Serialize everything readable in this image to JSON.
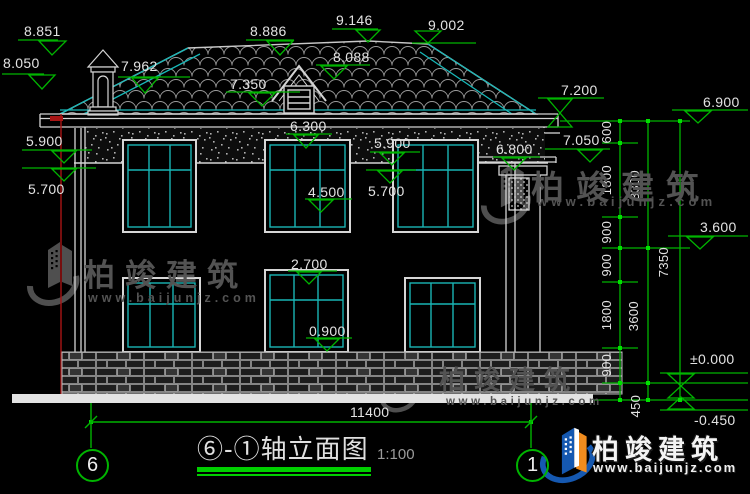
{
  "title_block": {
    "name": "⑥-①轴立面图",
    "scale": "1:100"
  },
  "axis": {
    "left": "6",
    "right": "1"
  },
  "elevations": {
    "v8851": "8.851",
    "v8050": "8.050",
    "v7962": "7.962",
    "v8886": "8.886",
    "v9146": "9.146",
    "v9002": "9.002",
    "v8088": "8.088",
    "v7350": "7.350",
    "v6300": "6.300",
    "v5900_left": "5.900",
    "v5700_left": "5.700",
    "v5900_mid": "5.900",
    "v5700_mid": "5.700",
    "v4500": "4.500",
    "v2700": "2.700",
    "v0900": "0.900",
    "v6800": "6.800",
    "v7200": "7.200",
    "v7050": "7.050",
    "v6900": "6.900",
    "v3600": "3.600",
    "v0000": "±0.000",
    "vm0450": "-0.450"
  },
  "chain_dims": {
    "d600": "600",
    "d1800_a": "1800",
    "d900_a": "900",
    "d900_b": "900",
    "d1800_b": "1800",
    "d900_c": "900",
    "d450": "450",
    "d3300": "3300",
    "d3600": "3600",
    "d7350": "7350",
    "d11400": "11400"
  },
  "watermark": {
    "brand": "柏竣建筑",
    "url": "www.baijunjz.com"
  },
  "colors": {
    "dim_green": "#00b400",
    "line_white": "#d4d4d4",
    "window_cyan": "#19b5b5",
    "axis_red": "#a81414",
    "logo_blue": "#1558b0",
    "logo_orange": "#f08c1e"
  }
}
